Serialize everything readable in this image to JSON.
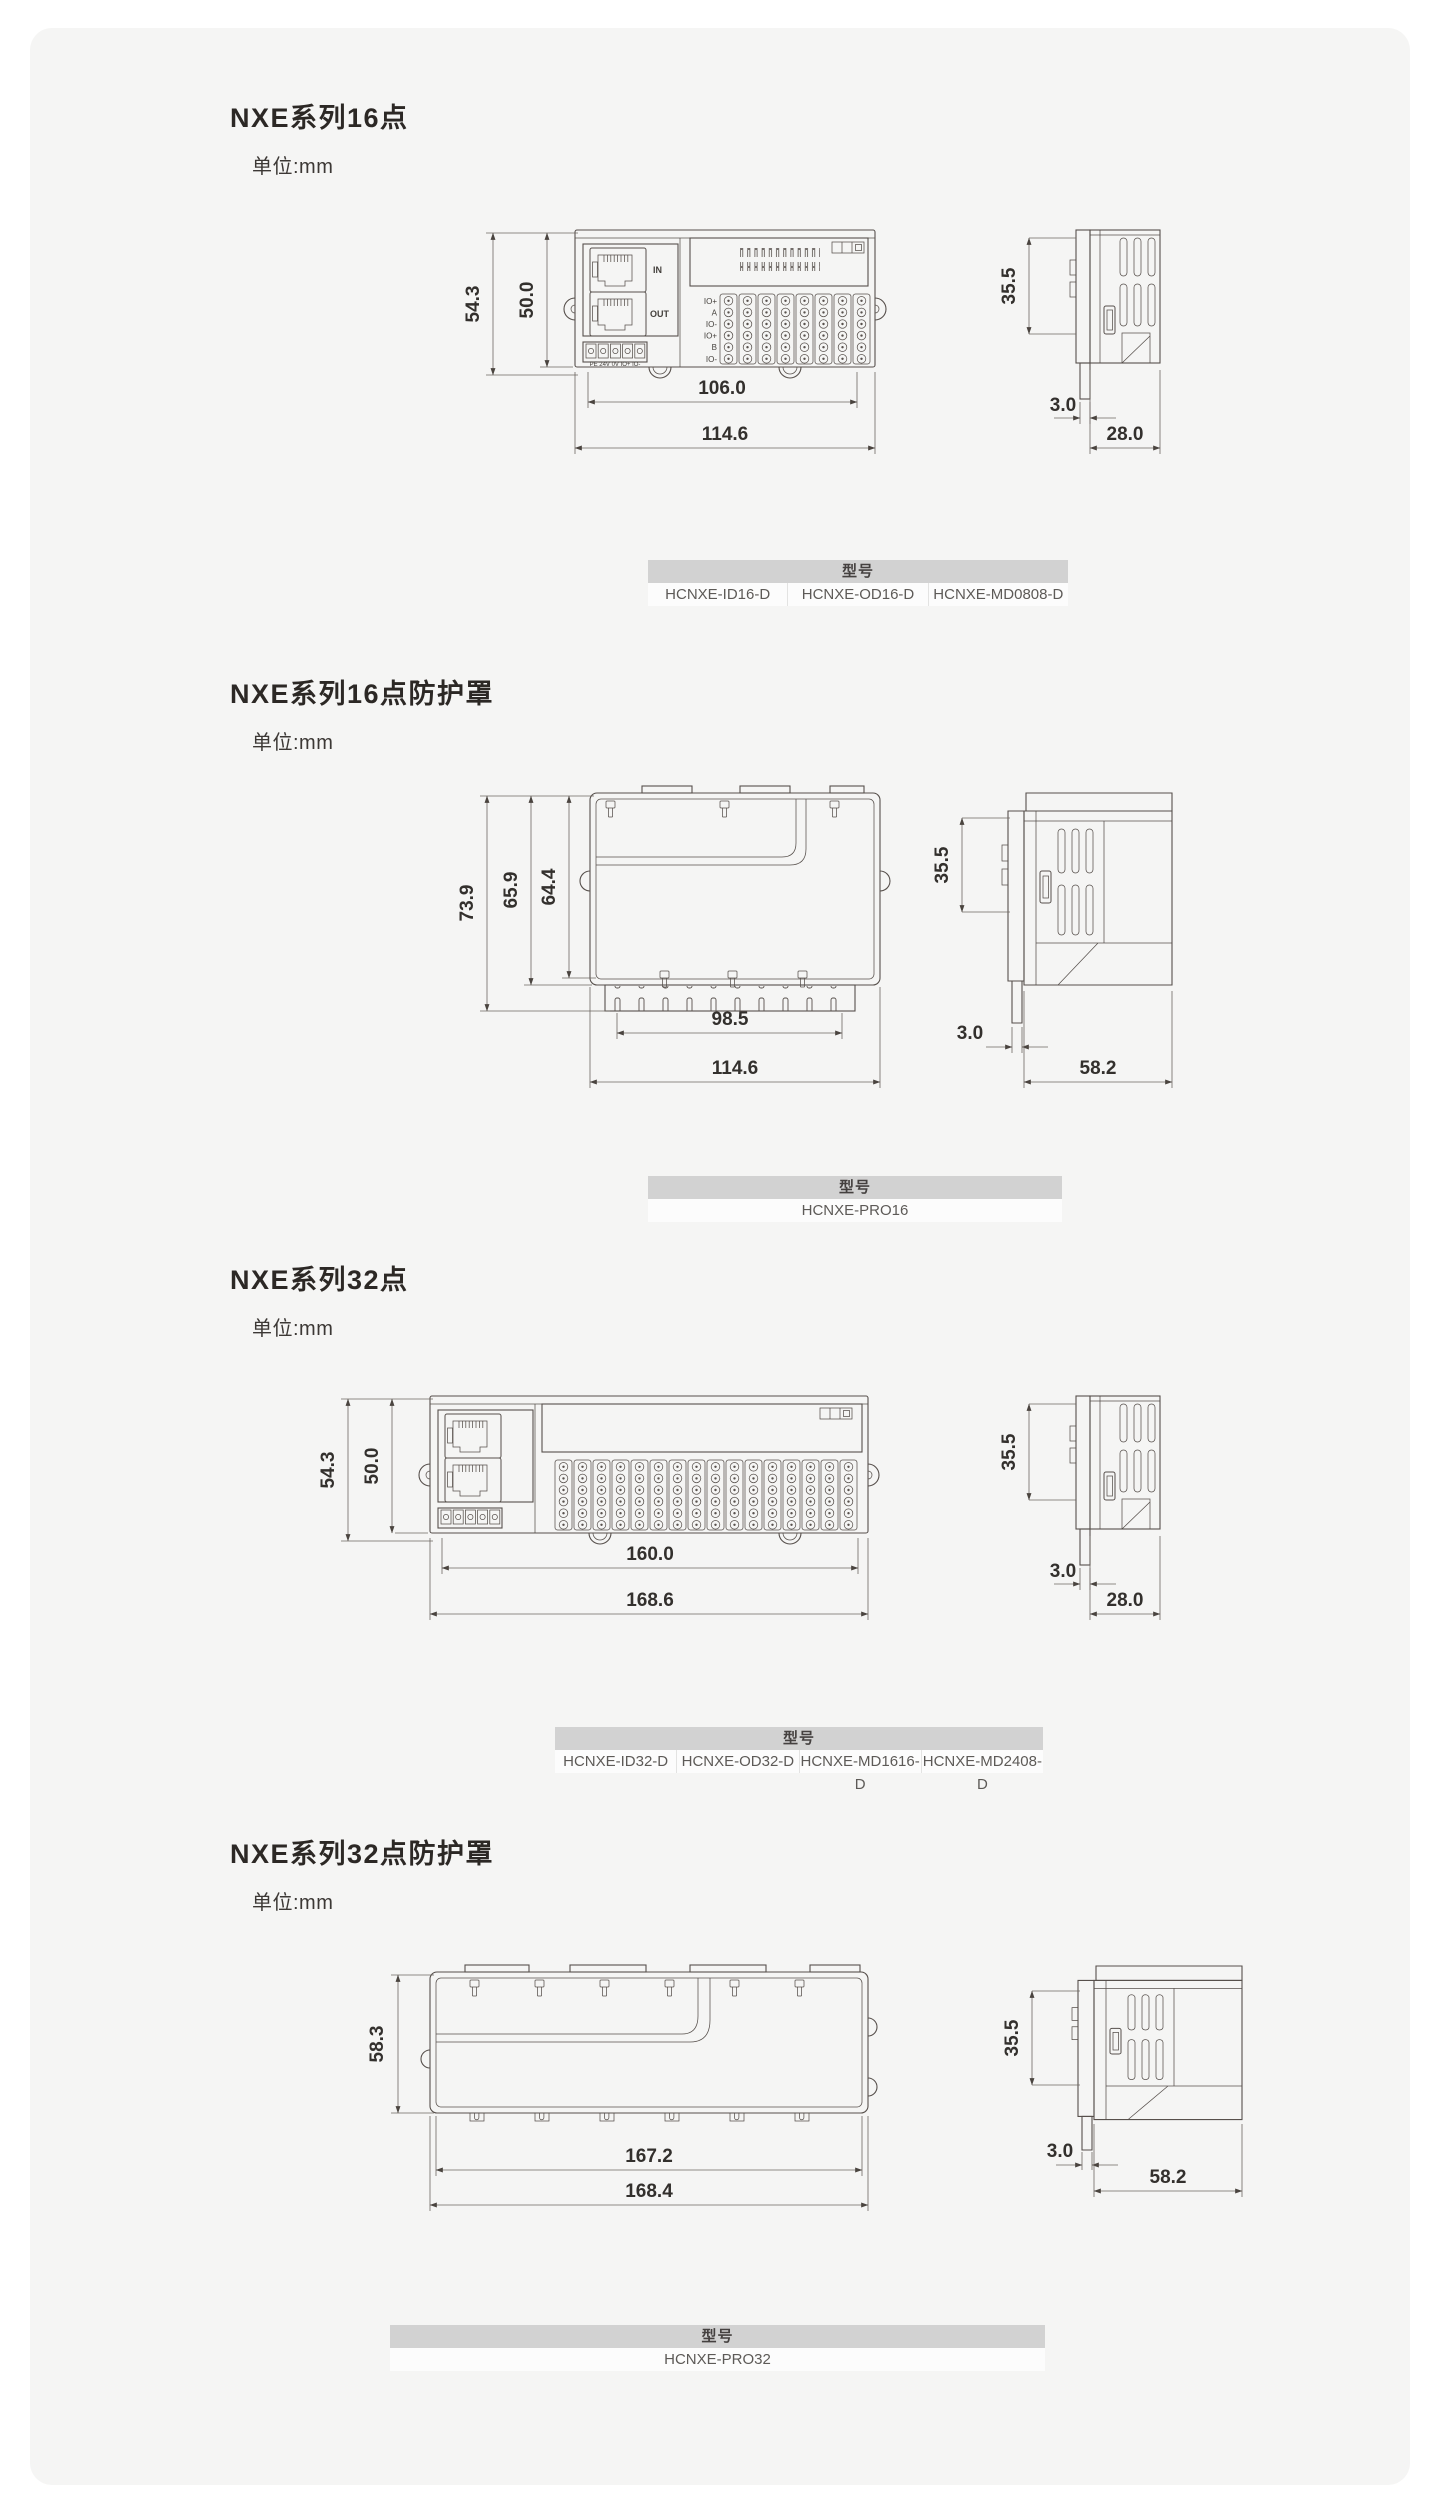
{
  "sections": [
    {
      "title": "NXE系列16点",
      "unit_label": "单位:mm",
      "drawing": {
        "front": {
          "h_outer": "54.3",
          "h_inner": "50.0",
          "w_inner": "106.0",
          "w_outer": "114.6"
        },
        "side": {
          "h": "35.5",
          "t": "3.0",
          "d": "28.0"
        },
        "labels": {
          "in": "IN",
          "out": "OUT",
          "power": "PE 24V 0V IO+ IO-"
        },
        "rows": [
          "IO+",
          "A",
          "IO-",
          "IO+",
          "B",
          "IO-"
        ]
      },
      "table": {
        "header": "型号",
        "models": [
          "HCNXE-ID16-D",
          "HCNXE-OD16-D",
          "HCNXE-MD0808-D"
        ]
      }
    },
    {
      "title": "NXE系列16点防护罩",
      "unit_label": "单位:mm",
      "drawing": {
        "front": {
          "h_outer": "73.9",
          "h_mid": "65.9",
          "h_inner": "64.4",
          "w_inner": "98.5",
          "w_outer": "114.6"
        },
        "side": {
          "h": "35.5",
          "t": "3.0",
          "d": "58.2"
        }
      },
      "table": {
        "header": "型号",
        "models": [
          "HCNXE-PRO16"
        ]
      }
    },
    {
      "title": "NXE系列32点",
      "unit_label": "单位:mm",
      "drawing": {
        "front": {
          "h_outer": "54.3",
          "h_inner": "50.0",
          "w_inner": "160.0",
          "w_outer": "168.6"
        },
        "side": {
          "h": "35.5",
          "t": "3.0",
          "d": "28.0"
        }
      },
      "table": {
        "header": "型号",
        "models": [
          "HCNXE-ID32-D",
          "HCNXE-OD32-D",
          "HCNXE-MD1616-D",
          "HCNXE-MD2408-D"
        ]
      }
    },
    {
      "title": "NXE系列32点防护罩",
      "unit_label": "单位:mm",
      "drawing": {
        "front": {
          "h_outer": "58.3",
          "w_inner": "167.2",
          "w_outer": "168.4"
        },
        "side": {
          "h": "35.5",
          "t": "3.0",
          "d": "58.2"
        }
      },
      "table": {
        "header": "型号",
        "models": [
          "HCNXE-PRO32"
        ]
      }
    }
  ]
}
